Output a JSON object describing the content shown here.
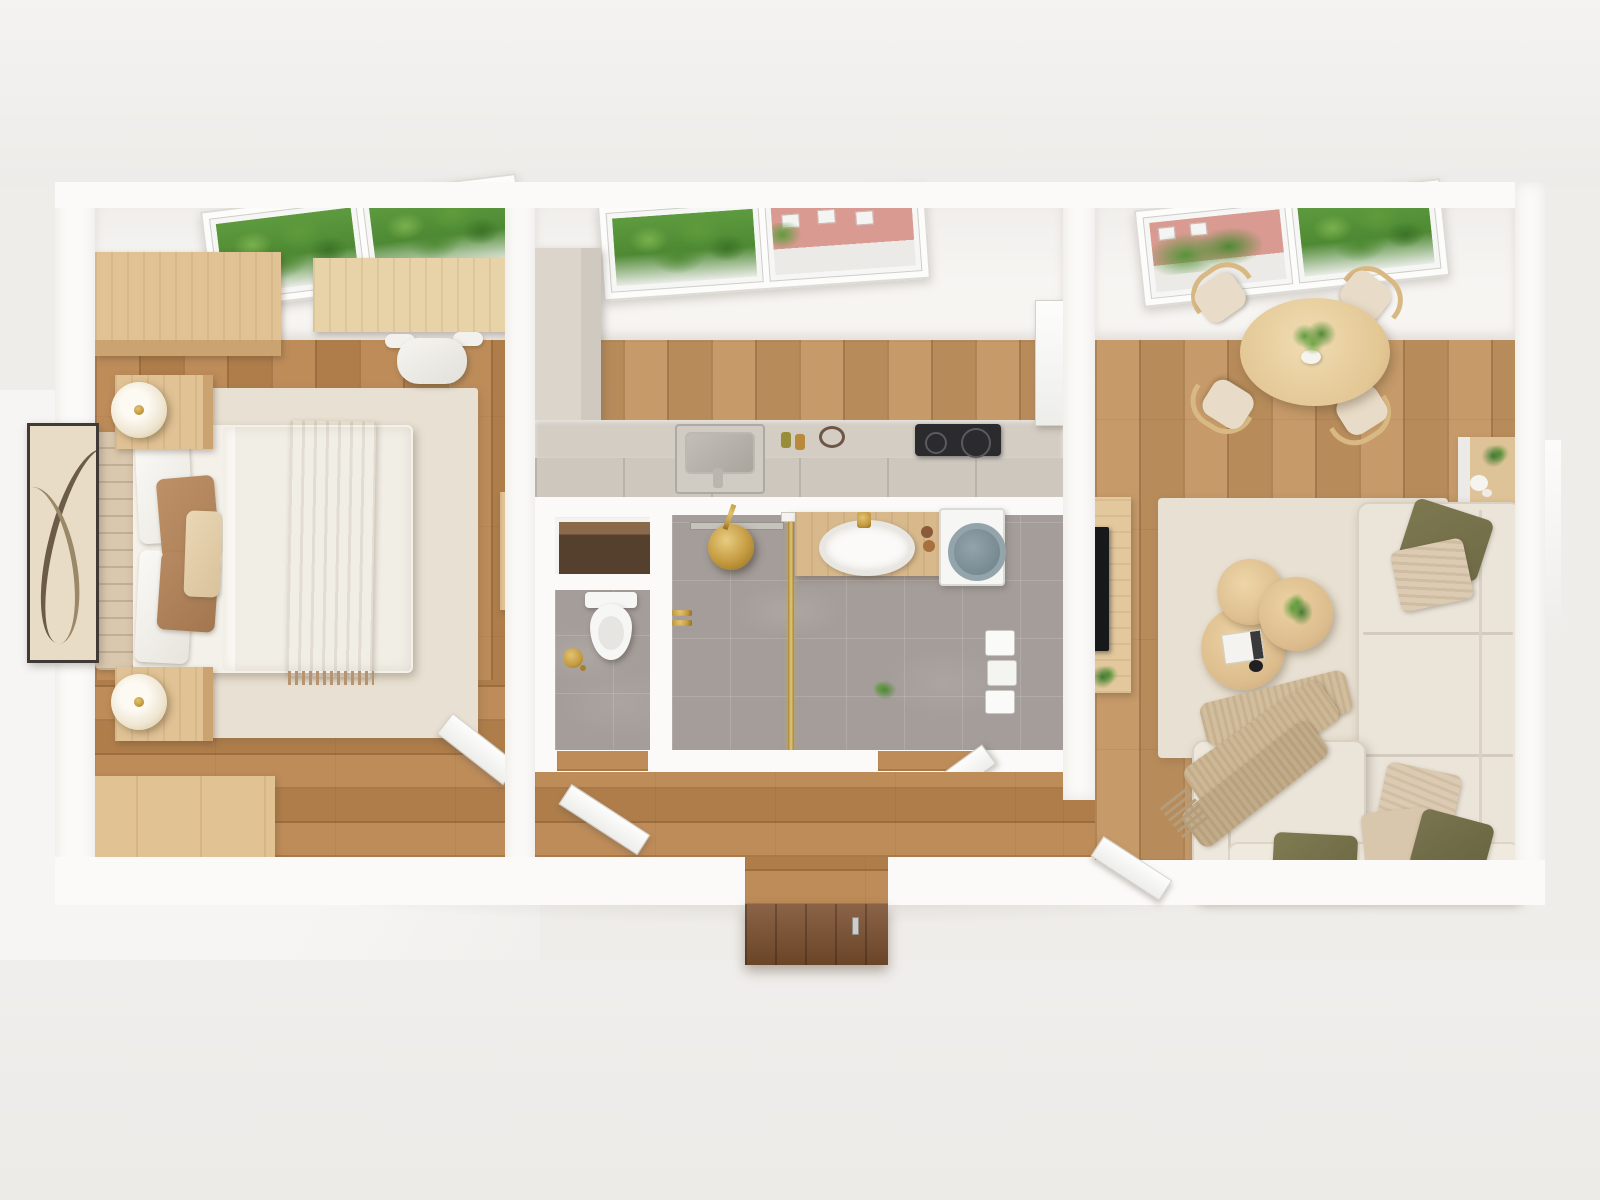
{
  "scene": {
    "type": "photoreal top-down 3D floor-plan render",
    "view": "bird's-eye cutaway of a small apartment",
    "rooms": [
      "bedroom",
      "kitchen",
      "wc",
      "bathroom",
      "hallway",
      "living-dining-room"
    ]
  },
  "palette": {
    "outside": "#efedea",
    "wall": "#fbfaf8",
    "ceiling": "#f7f5f2",
    "wood-floor": "#b9854f",
    "wood-floor-light": "#c29460",
    "wood-furniture": "#e0c295",
    "wood-furniture-dark": "#caa371",
    "dark-wood-door": "#7a4e2d",
    "tile": "#a49d99",
    "counter": "#d3cdc4",
    "cabinet": "#dbd5cc",
    "sofa": "#eae4d9",
    "rug": "#e8e0d2",
    "bed-duvet": "#f4f1ea",
    "throw-tan": "#c7a585",
    "pillow-brown": "#ad8057",
    "pillow-olive": "#6f6b46",
    "pillow-beige": "#dccbb2",
    "gold": "#c49a3f",
    "cooktop": "#2b2b2e",
    "tv": "#17181a",
    "greenery": "#4e8a33",
    "greenery-light": "#7ab14e",
    "building-pink": "#d99a91",
    "washer-ring": "#93a5ab",
    "toilet-white": "#f6f6f4",
    "lamp-cream": "#efe6d2"
  },
  "bedroom": {
    "label": "bedroom",
    "furniture": [
      "skylight-window",
      "wardrobe",
      "desk",
      "office-chair",
      "double-bed",
      "headboard",
      "white-pillows",
      "brown-pillows",
      "tan-throw",
      "area-rug",
      "nightstand-with-lamp x2",
      "wall-art",
      "storage-bench",
      "slim-wall-cabinet",
      "interior-door"
    ]
  },
  "kitchen": {
    "label": "kitchen",
    "furniture": [
      "skylight-window",
      "tall-cabinet",
      "counter-run",
      "inset-sink",
      "induction-cooktop",
      "open-door-leaf"
    ]
  },
  "wc": {
    "label": "wc",
    "furniture": [
      "storage-niche",
      "toilet",
      "gold-brush-set",
      "door-leaf"
    ]
  },
  "bathroom": {
    "label": "bathroom",
    "furniture": [
      "rain-shower-head",
      "gold-valve",
      "glass-partition",
      "wood-vanity",
      "oval-basin",
      "gold-faucet",
      "washing-machine",
      "towel-rack",
      "door-leaf",
      "small-plant"
    ]
  },
  "hallway": {
    "label": "hallway",
    "furniture": [
      "entrance-door-dark-wood"
    ]
  },
  "living": {
    "label": "living-dining-room",
    "furniture": [
      "skylight-window",
      "round-dining-table",
      "dining-chairs x4",
      "table-plant",
      "wall-shelf-with-plant",
      "tv-console",
      "tv",
      "floor-plant",
      "area-rug",
      "nesting-coffee-tables x3",
      "coffee-table-plant",
      "book",
      "bowl",
      "l-shaped-sofa",
      "olive-pillows",
      "beige-pillows",
      "fringed-throw",
      "interior-door"
    ]
  }
}
